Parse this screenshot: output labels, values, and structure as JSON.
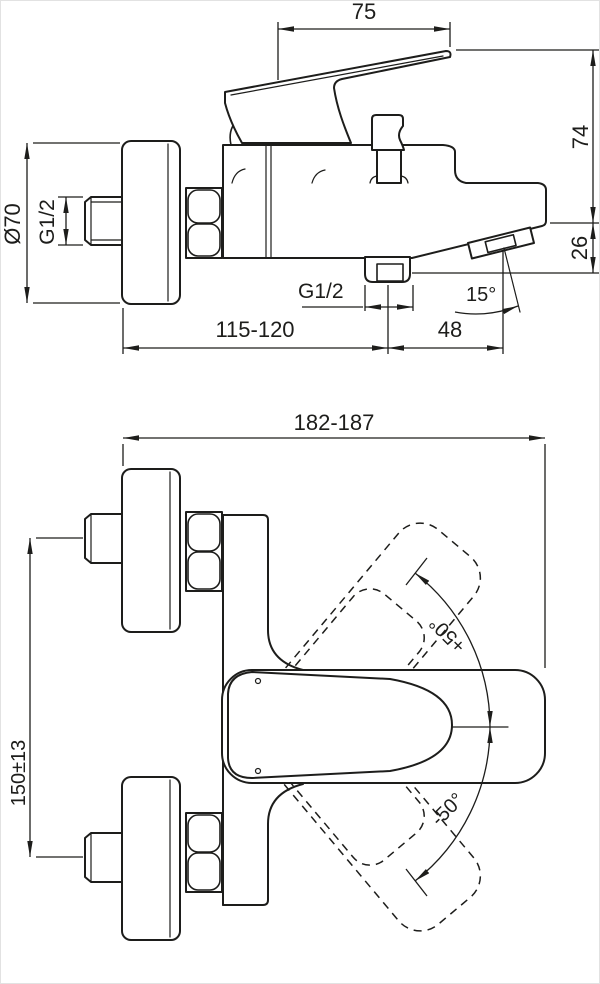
{
  "drawing": {
    "ink_color": "#1d1d1b",
    "background_color": "#ffffff",
    "side_view": {
      "labels": {
        "handle_length": "75",
        "height_to_spout": "74",
        "spout_end_drop": "26",
        "flange_diameter": "Ø70",
        "inlet_thread": "G1/2",
        "shower_outlet_thread": "G1/2",
        "spout_angle": "15°",
        "wall_to_outlet": "115-120",
        "spout_extra_reach": "48"
      }
    },
    "front_view": {
      "labels": {
        "overall_width": "182-187",
        "connection_spacing": "150±13",
        "handle_swing_up": "+50°",
        "handle_swing_down": "-50°"
      }
    }
  }
}
